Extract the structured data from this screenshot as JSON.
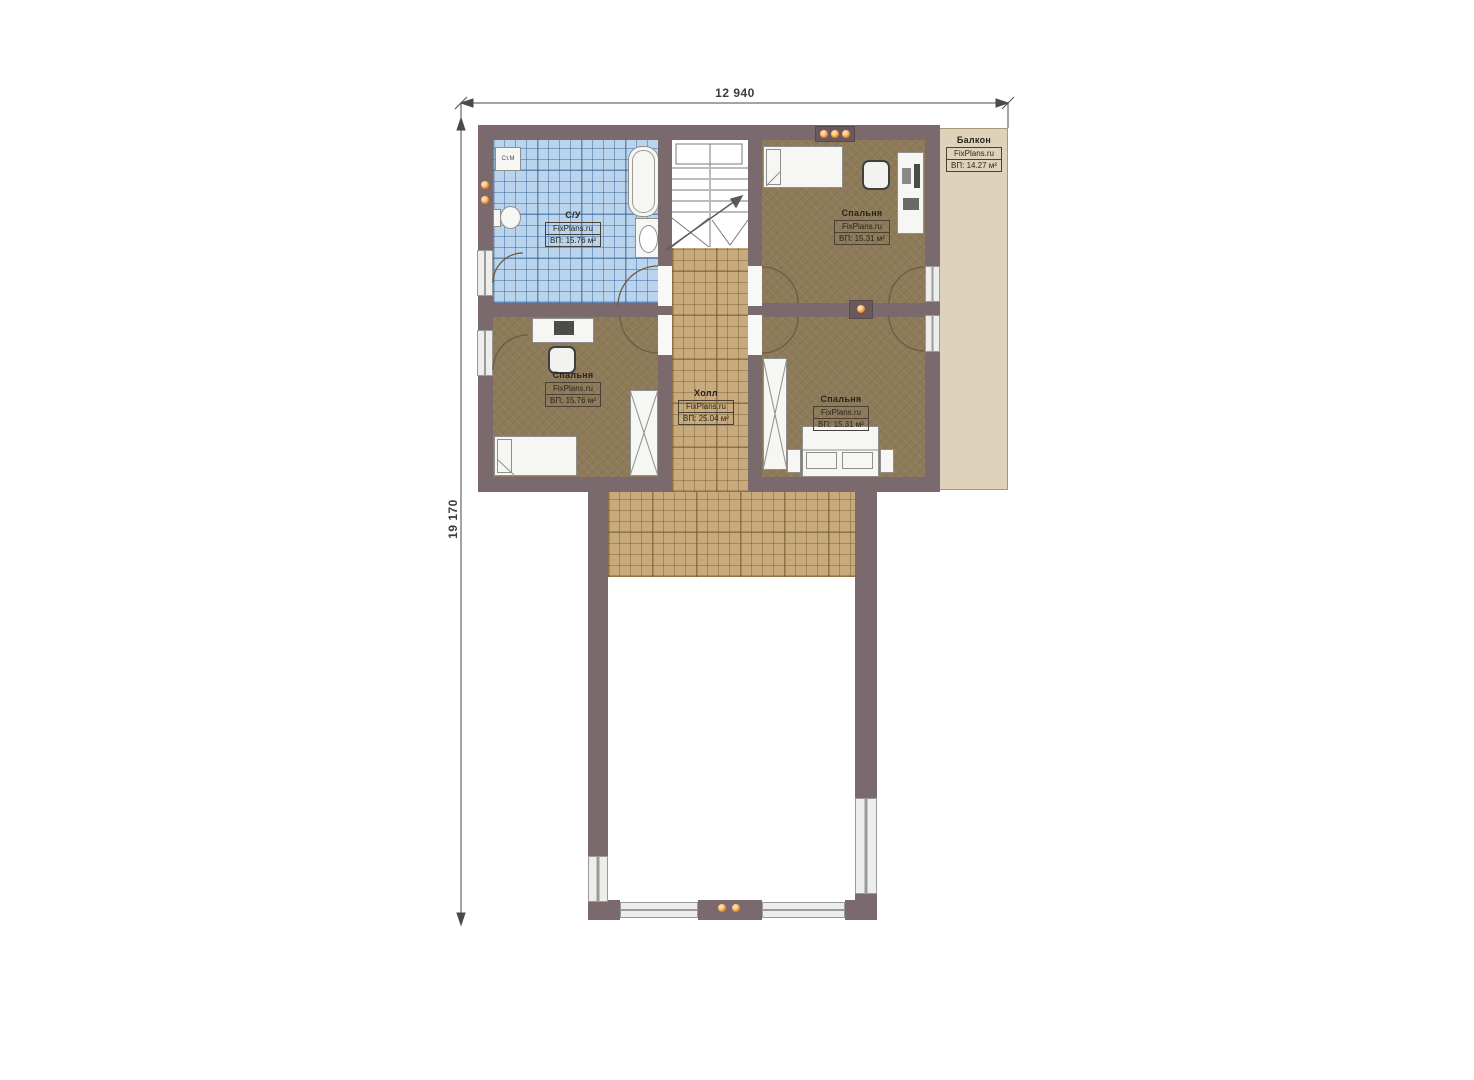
{
  "dimensions": {
    "top": "12 940",
    "left": "19 170"
  },
  "rooms": {
    "bathroom": {
      "name": "С/У",
      "brand": "FixPlans.ru",
      "area": "ВП: 15.76 м²"
    },
    "bedroom_top_right": {
      "name": "Спальня",
      "brand": "FixPlans.ru",
      "area": "ВП: 15.31 м²"
    },
    "bedroom_left": {
      "name": "Спальня",
      "brand": "FixPlans.ru",
      "area": "ВП: 15.76 м²"
    },
    "bedroom_bottom_right": {
      "name": "Спальня",
      "brand": "FixPlans.ru",
      "area": "ВП: 15.31 м²"
    },
    "hall": {
      "name": "Холл",
      "brand": "FixPlans.ru",
      "area": "ВП: 25.04 м²"
    },
    "balcony": {
      "name": "Балкон",
      "brand": "FixPlans.ru",
      "area": "ВП: 14.27 м²"
    }
  },
  "appliances": {
    "washing_machine": "Ст.М"
  },
  "colors": {
    "wall": "#7b6a6d",
    "floor-bedroom": "#8d7a58",
    "floor-hall": "#c7ab7d",
    "tile-bath": "#b9d4ec",
    "balcony": "#ded2bb",
    "socket-orange": "#e8872a",
    "dim-text": "#3c3c3c",
    "label-text": "#2b251d"
  }
}
